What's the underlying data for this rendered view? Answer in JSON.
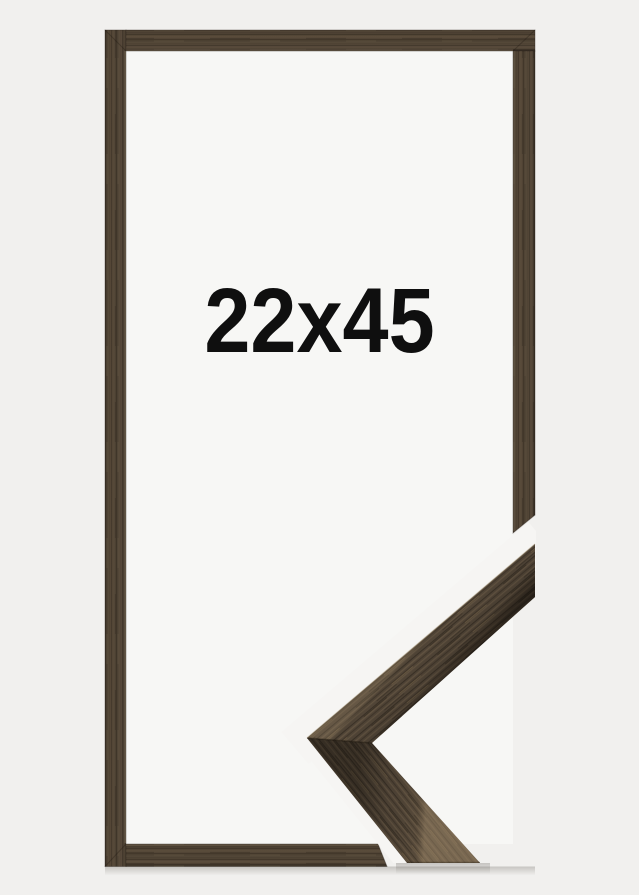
{
  "frame": {
    "size_label": "22x45",
    "colors": {
      "background": "#f1f0ee",
      "frame_opening": "#f7f7f5",
      "wood_base": "#4e4234",
      "wood_dark": "#342b21",
      "wood_light": "#6e5e49",
      "label_text": "#0f0f0f"
    }
  }
}
